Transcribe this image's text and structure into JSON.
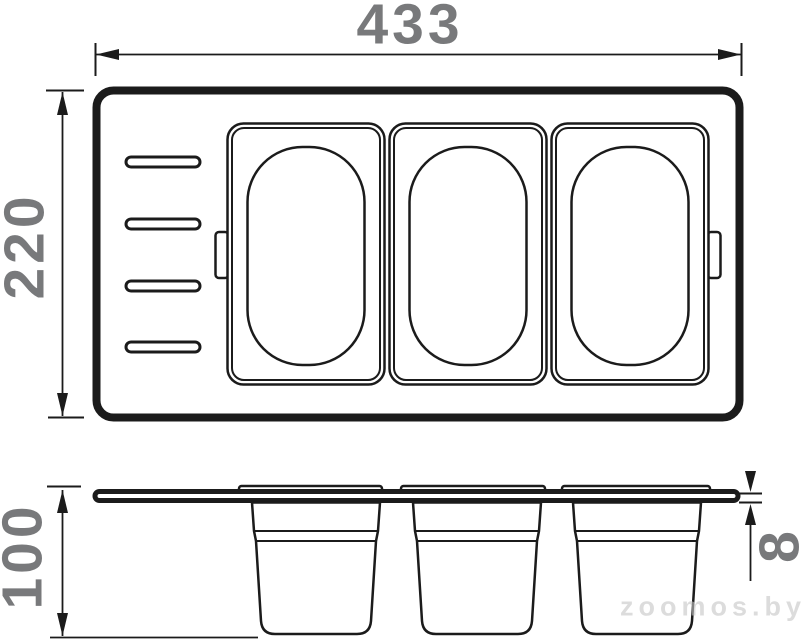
{
  "dimensions": {
    "top_width": "433",
    "left_height": "220",
    "side_height": "100",
    "board_thickness": "8"
  },
  "watermark": "zoomos.by",
  "colors": {
    "line": "#1b1b1b",
    "dimension_text": "#78797b",
    "watermark_text": "#c6c6c6",
    "background": "#ffffff"
  },
  "views": {
    "top_view": {
      "slots": 4,
      "containers": 3,
      "side_tabs": 2
    },
    "side_view": {
      "rim_segments": 3,
      "buckets": 3
    }
  }
}
